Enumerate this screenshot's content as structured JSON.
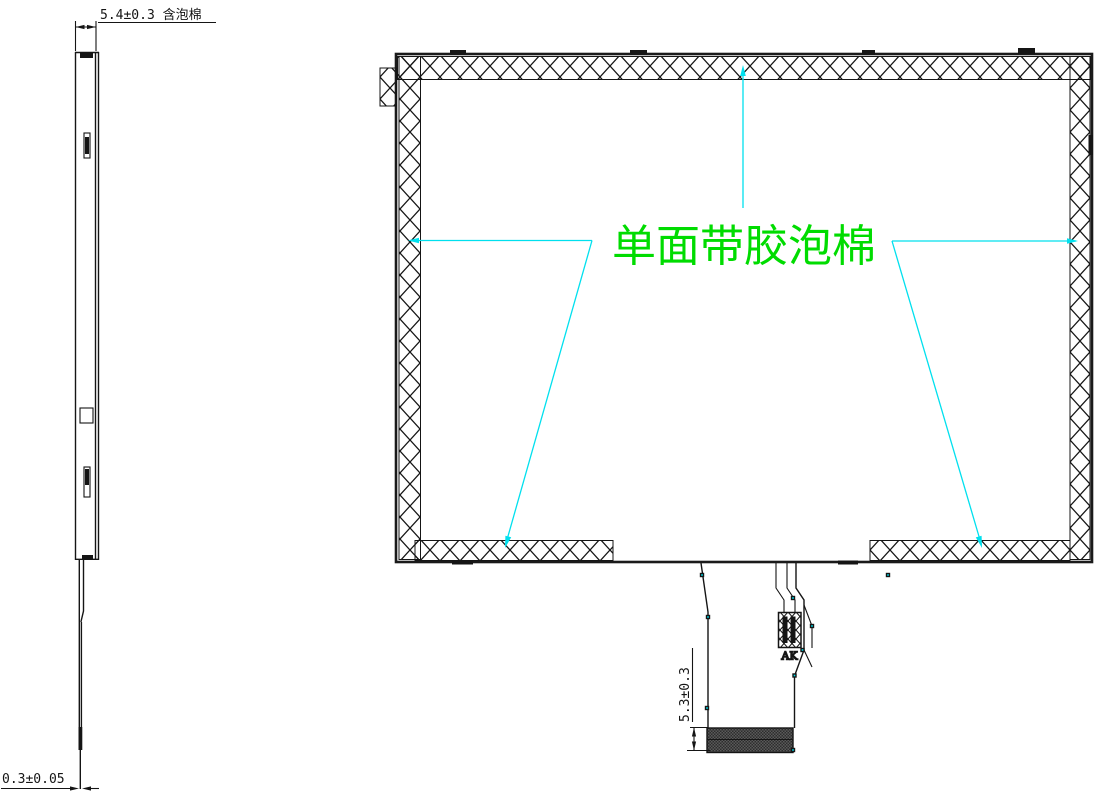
{
  "labels": {
    "foam_annotation": "单面带胶泡棉",
    "connector": "AK"
  },
  "dimensions": {
    "top_thickness": "5.4±0.3 含泡棉",
    "film_thickness": "0.3±0.05",
    "fpc_tail": "5.3±0.3"
  },
  "colors": {
    "annotation_green": "#00DC00",
    "leader_cyan": "#00E0EE",
    "line_ink": "#151515",
    "stiffener_gray": "#3A3A3A"
  }
}
